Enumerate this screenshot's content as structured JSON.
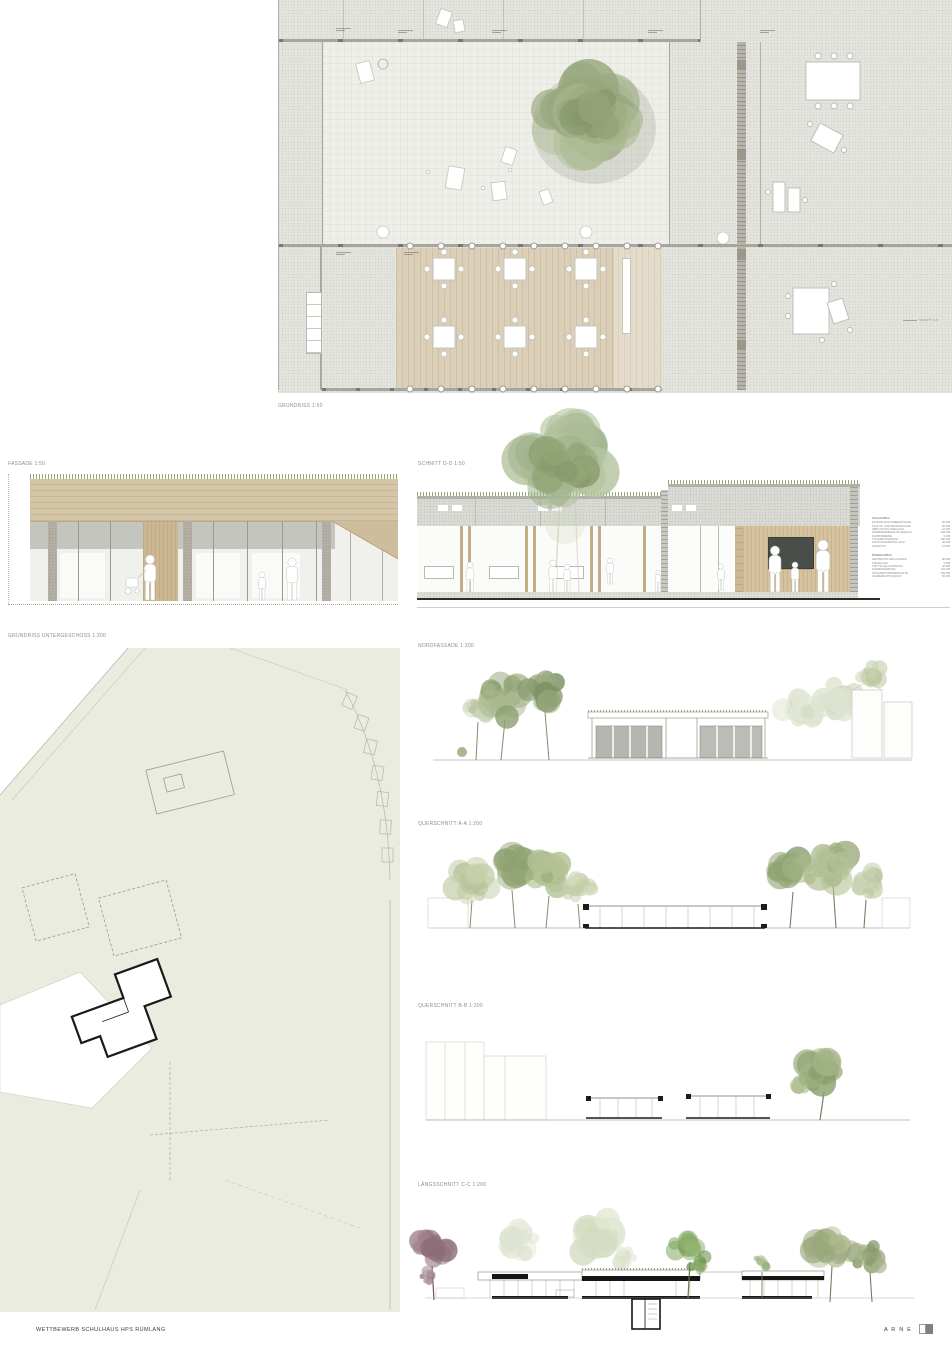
{
  "board": {
    "footer_title": "WETTBEWERB SCHULHAUS HPS RÜMLANG",
    "studio": "A R N E"
  },
  "drawings": {
    "grundriss": {
      "label": "GRUNDRISS 1:50"
    },
    "fassade": {
      "label": "FASSADE 1:50"
    },
    "schnitt_dd": {
      "label": "SCHNITT D-D 1:50"
    },
    "untergeschoss": {
      "label": "GRUNDRISS UNTERGESCHOSS 1:200"
    },
    "nordfassade": {
      "label": "NORDFASSADE 1:200"
    },
    "querschnitt_aa": {
      "label": "QUERSCHNITT A-A 1:200"
    },
    "querschnitt_bb": {
      "label": "QUERSCHNITT B-B 1:200"
    },
    "laengsschnitt_cc": {
      "label": "LÄNGSSCHNITT C-C 1:200"
    },
    "schnitt_marker": "SCHNITT D-D"
  },
  "legend": {
    "dach": {
      "heading": "DACHAUFBAU",
      "rows": [
        {
          "label": "EXTENSIVE DACHBEGRÜNUNG",
          "value": "80 MM"
        },
        {
          "label": "SCHUTZ- UND DRAINAGELAGE",
          "value": "20 MM"
        },
        {
          "label": "ABDICHTUNG ZWEILAGIG",
          "value": "10 MM"
        },
        {
          "label": "WÄRMEDÄMMUNG IM GEFÄLLE",
          "value": "160 MM"
        },
        {
          "label": "DAMPFBREMSE",
          "value": "5 MM"
        },
        {
          "label": "STAHLBETONDECKE",
          "value": "280 MM"
        },
        {
          "label": "AKUSTIKELEMENTE HOLZ",
          "value": "40 MM"
        },
        {
          "label": "LEHMPUTZ",
          "value": "15 MM"
        }
      ]
    },
    "boden": {
      "heading": "BODENAUFBAU",
      "rows": [
        {
          "label": "HARTBETON GESCHLIFFEN",
          "value": "80 MM"
        },
        {
          "label": "TRENNLAGE",
          "value": "5 MM"
        },
        {
          "label": "TRITTSCHALLDÄMMUNG",
          "value": "40 MM"
        },
        {
          "label": "WÄRMEDÄMMUNG",
          "value": "120 MM"
        },
        {
          "label": "STAHLBETONBODENPLATTE",
          "value": "250 MM"
        },
        {
          "label": "SAUBERKEITSSCHICHT",
          "value": "50 MM"
        }
      ]
    }
  },
  "palette": {
    "concrete": "#e4e4df",
    "courtyard": "#efefe9",
    "wood_deck": "#dbcfb8",
    "wood_facade": "#d5c6a7",
    "site_green": "#eaecdf",
    "tree_green": "#9cab82",
    "chalkboard": "#4a4e49",
    "cut_black": "#1a1a18"
  }
}
